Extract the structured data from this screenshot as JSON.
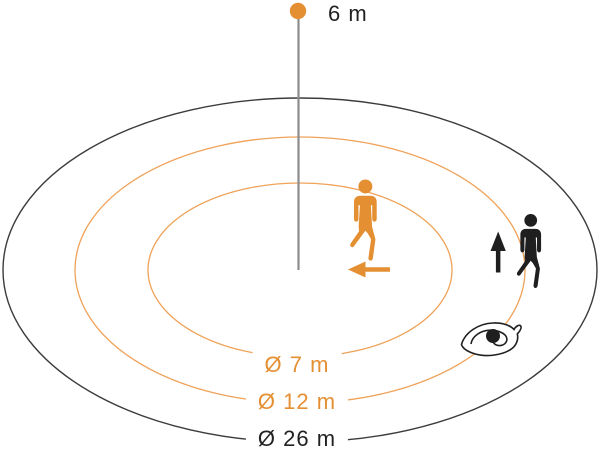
{
  "diagram": {
    "type": "motion-detector-coverage",
    "sensor": {
      "mounting_height_label": "6 m",
      "mounting_height_m": 6
    },
    "zones": [
      {
        "id": "inner",
        "label": "Ø 7 m",
        "diameter_m": 7,
        "line_color": "#EFA258"
      },
      {
        "id": "middle",
        "label": "Ø 12 m",
        "diameter_m": 12,
        "line_color": "#EFA258"
      },
      {
        "id": "outer",
        "label": "Ø 26 m",
        "diameter_m": 26,
        "line_color": "#3C3C3C"
      }
    ],
    "icons": {
      "tangential_walker": "walking-person-orange",
      "radial_walker": "walking-person-black",
      "tangential_arrow": "arrow-left",
      "radial_arrow": "arrow-up",
      "sensor_eye": "eye-sensor"
    }
  },
  "colors": {
    "orange": "#E58F33",
    "orange_line": "#EFA258",
    "black": "#1F1F1F",
    "outer_line": "#3C3C3C",
    "gray_line": "#8C8C8C",
    "white": "#FFFFFF"
  }
}
